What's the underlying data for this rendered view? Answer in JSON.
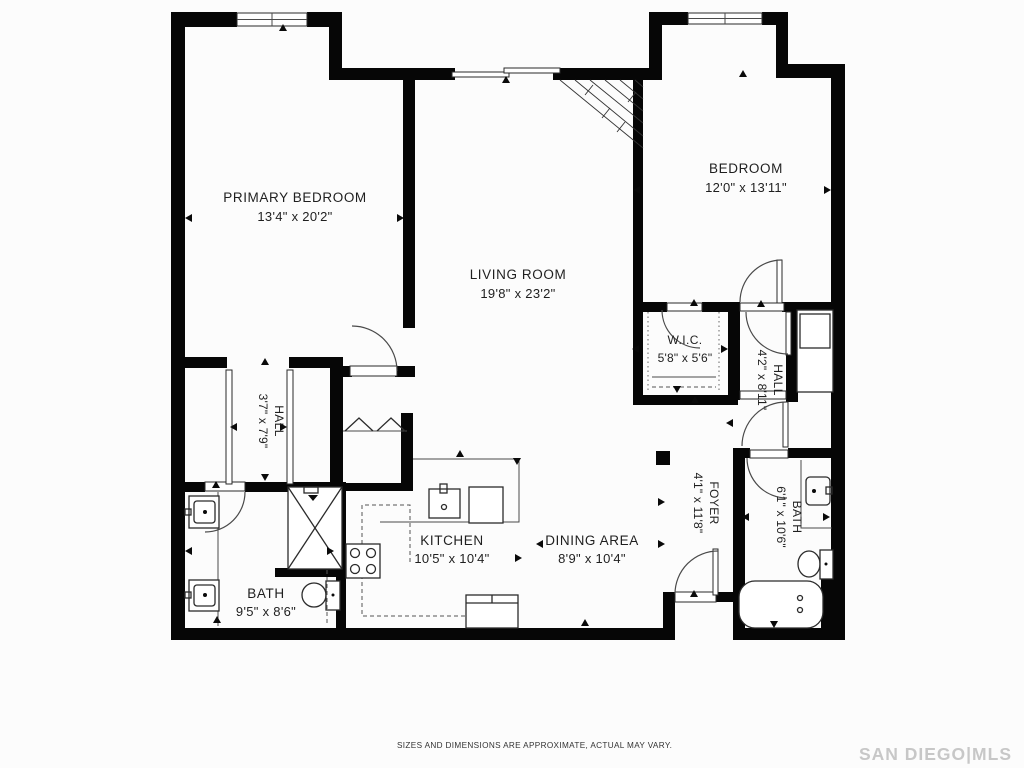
{
  "rooms": {
    "primary_bedroom": {
      "label": "PRIMARY BEDROOM",
      "dims": "13'4\" x 20'2\""
    },
    "bedroom": {
      "label": "BEDROOM",
      "dims": "12'0\" x 13'11\""
    },
    "living_room": {
      "label": "LIVING ROOM",
      "dims": "19'8\" x 23'2\""
    },
    "wic": {
      "label": "W.I.C.",
      "dims": "5'8\" x 5'6\""
    },
    "hall_right": {
      "label": "HALL",
      "dims": "4'2\" x 8'11\""
    },
    "hall_left": {
      "label": "HALL",
      "dims": "3'7\" x 7'9\""
    },
    "foyer": {
      "label": "FOYER",
      "dims": "4'1\" x 11'8\""
    },
    "bath_right": {
      "label": "BATH",
      "dims": "6'1\" x 10'6\""
    },
    "bath_left": {
      "label": "BATH",
      "dims": "9'5\" x 8'6\""
    },
    "kitchen": {
      "label": "KITCHEN",
      "dims": "10'5\" x 10'4\""
    },
    "dining": {
      "label": "DINING AREA",
      "dims": "8'9\" x 10'4\""
    }
  },
  "footer": {
    "disclaimer": "SIZES AND DIMENSIONS ARE APPROXIMATE, ACTUAL MAY VARY.",
    "watermark": "SAN DIEGO|MLS"
  }
}
